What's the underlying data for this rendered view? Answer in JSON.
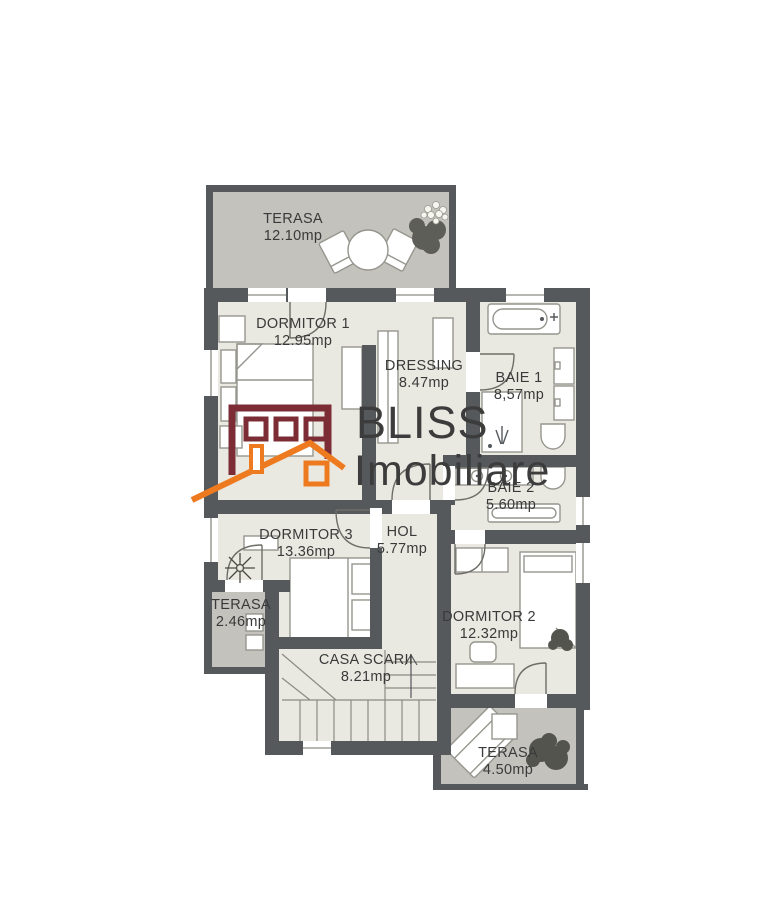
{
  "watermark": {
    "line1": "BLISS",
    "line2": "Imobiliare"
  },
  "rooms": [
    {
      "name": "TERASA",
      "area": "12.10mp"
    },
    {
      "name": "DORMITOR 1",
      "area": "12.95mp"
    },
    {
      "name": "DRESSING",
      "area": "8.47mp"
    },
    {
      "name": "BAIE 1",
      "area": "8,57mp"
    },
    {
      "name": "BAIE 2",
      "area": "5.60mp"
    },
    {
      "name": "DORMITOR 3",
      "area": "13.36mp"
    },
    {
      "name": "HOL",
      "area": "5.77mp"
    },
    {
      "name": "TERASA",
      "area": "2.46mp"
    },
    {
      "name": "CASA SCARII",
      "area": "8.21mp"
    },
    {
      "name": "DORMITOR 2",
      "area": "12.32mp"
    },
    {
      "name": "TERASA",
      "area": "4.50mp"
    }
  ],
  "colors": {
    "wall": "#55595c",
    "floor": "#eae9e1",
    "terrace": "#c3c2bc",
    "logo_maroon": "#7b2c34",
    "logo_orange": "#ee7a20",
    "label_text": "#3a3a3a",
    "watermark_text": "#3c3c3c"
  }
}
